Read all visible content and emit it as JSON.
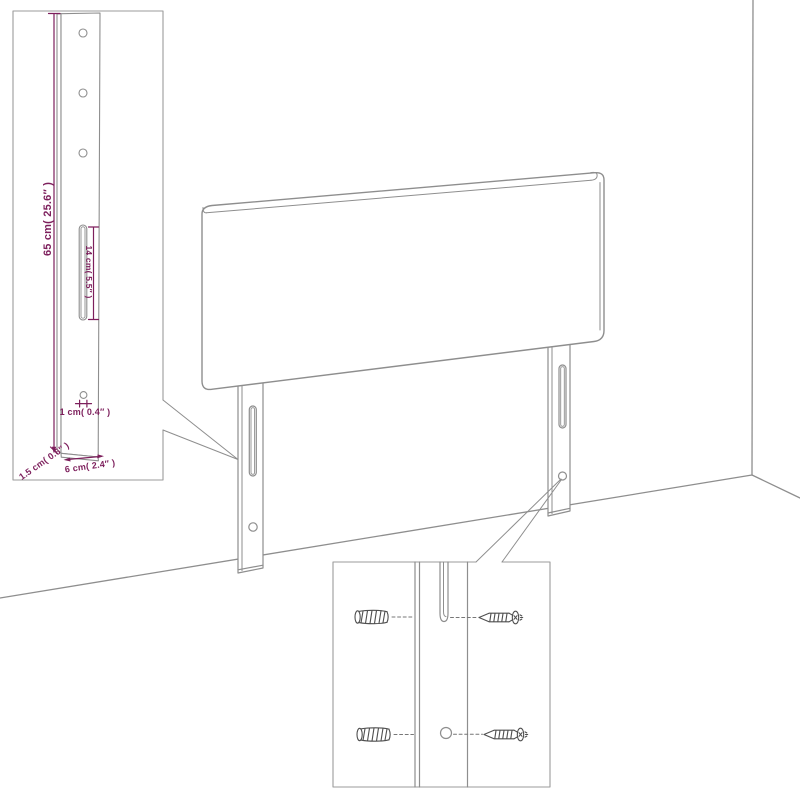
{
  "diagram_title": "",
  "colors": {
    "background": "#ffffff",
    "outline_gray": "#8e8e8e",
    "dimension_purple": "#7d1f5c",
    "hardware_dark": "#4f4f4f"
  },
  "labels": {
    "leg_height": "65 cm( 25.6″ )",
    "slot_length": "14 cm( 5.5″ )",
    "hole_size": "1 cm( 0.4″ )",
    "leg_depth": "1.5 cm( 0.6″ )",
    "leg_width": "6 cm( 2.4″ )"
  },
  "icons": [
    "headboard-panel",
    "mounting-leg-icon",
    "slot-icon",
    "screw-hole-icon",
    "wall-plug-icon",
    "screw-icon",
    "wall-corner-line",
    "floor-line",
    "callout-wedge"
  ]
}
